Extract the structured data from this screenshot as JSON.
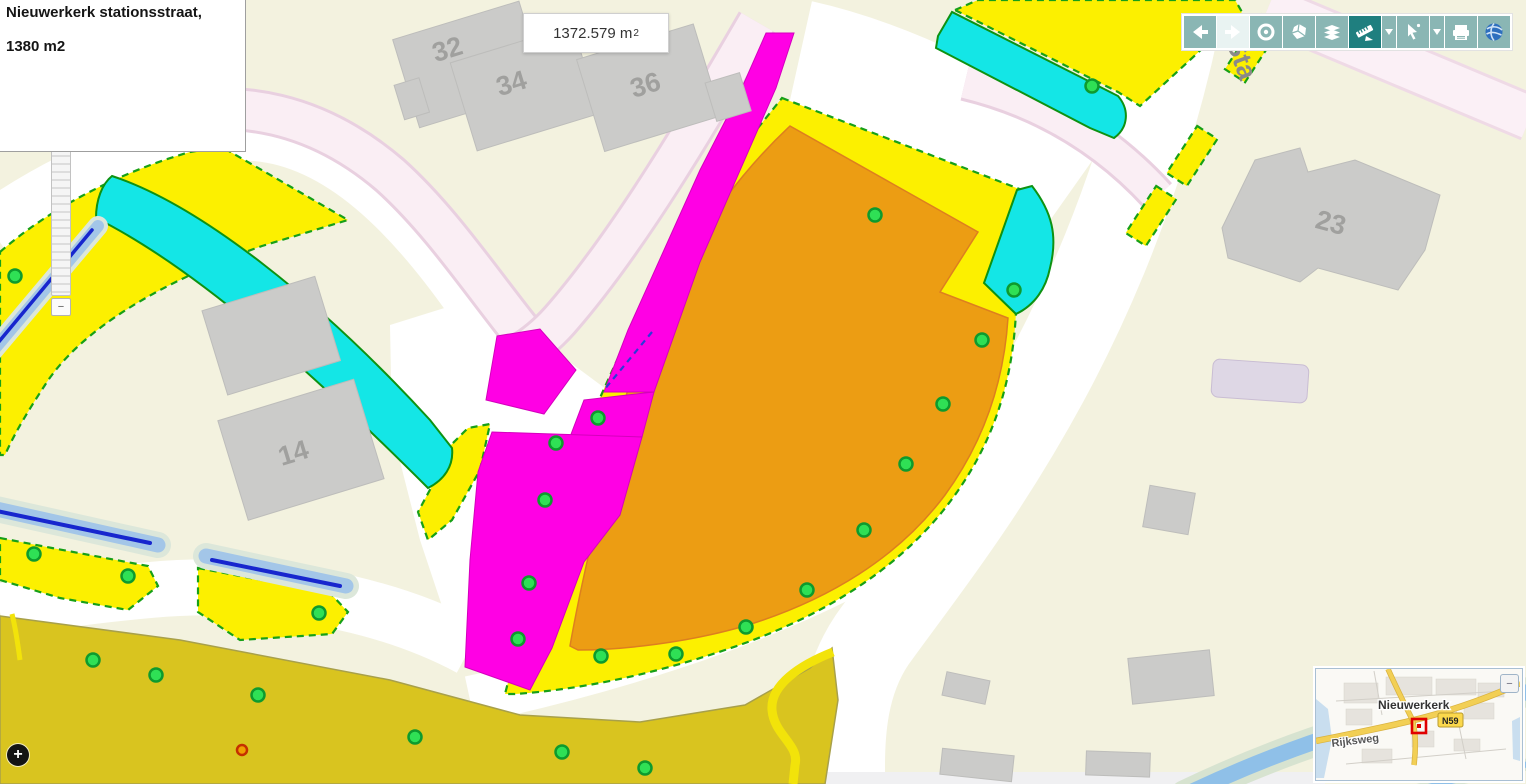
{
  "info_panel": {
    "title": "Nieuwerkerk stationsstraat,",
    "area": "1380 m2"
  },
  "measurement": {
    "value": "1372.579 m",
    "sup": "2"
  },
  "map": {
    "street_label": "Sta",
    "house_numbers": {
      "b32": "32",
      "b34": "34",
      "b36": "36",
      "b14": "14",
      "b23": "23"
    }
  },
  "zoom_slider": {
    "handle_label": "−"
  },
  "expand_button": {
    "label": "+"
  },
  "toolbar": {
    "buttons": [
      "back",
      "forward",
      "zoom-full-extent",
      "identify",
      "layers",
      "measure",
      "select",
      "print",
      "globe"
    ]
  },
  "minimap": {
    "town": "Nieuwerkerk",
    "road_badge": "N59",
    "street": "Rijksweg",
    "collapse_label": "−"
  },
  "colors": {
    "parcel_yellow": "#FCF000",
    "parcel_orange": "#EC9D13",
    "parcel_magenta": "#FF00E4",
    "parcel_cyan": "#14E6E6",
    "olive_field": "#D9C41F",
    "marker_green": "#2FE055",
    "toolbar_teal": "#8AB6B4",
    "toolbar_active": "#1F7F7F",
    "water_blue": "#1726CE"
  }
}
